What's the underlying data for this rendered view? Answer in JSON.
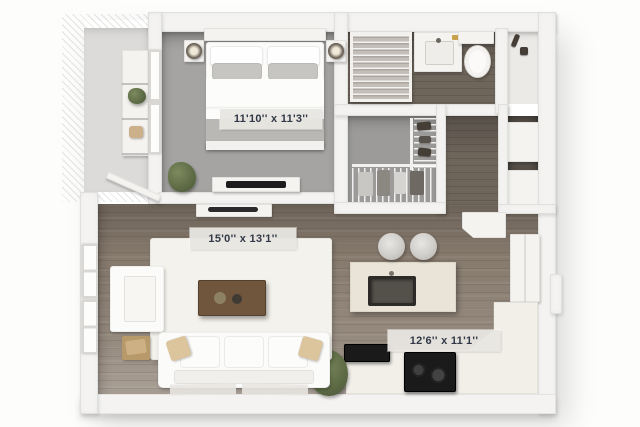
{
  "floorplan": {
    "view": "3d-top-down-apartment-floor-plan",
    "rooms": {
      "bedroom": {
        "dimensions": "11'10'' x 11'3''"
      },
      "living_room": {
        "dimensions": "15'0'' x 13'1''"
      },
      "kitchen": {
        "dimensions": "12'6'' x 11'1''"
      }
    },
    "palette": {
      "background": "#fdfdfc",
      "wall": "#f4f3f1",
      "bedroom_carpet": "#a5a4a2",
      "closet_carpet": "#9c9b99",
      "wood_floor": "#8b7e71",
      "dark_wood_floor": "#6e655b",
      "balcony_floor": "#dcdbd9",
      "rug": "#f4f2ec",
      "island": "#eae4d8",
      "counter": "#f2efe9",
      "appliance_black": "#1a1a1a",
      "label_bg": "rgba(232,230,226,0.95)",
      "label_text": "#313946",
      "plant_green": "#5d6b45",
      "pillow_tan": "#dcc49c",
      "table_wood": "#6f563d"
    }
  }
}
